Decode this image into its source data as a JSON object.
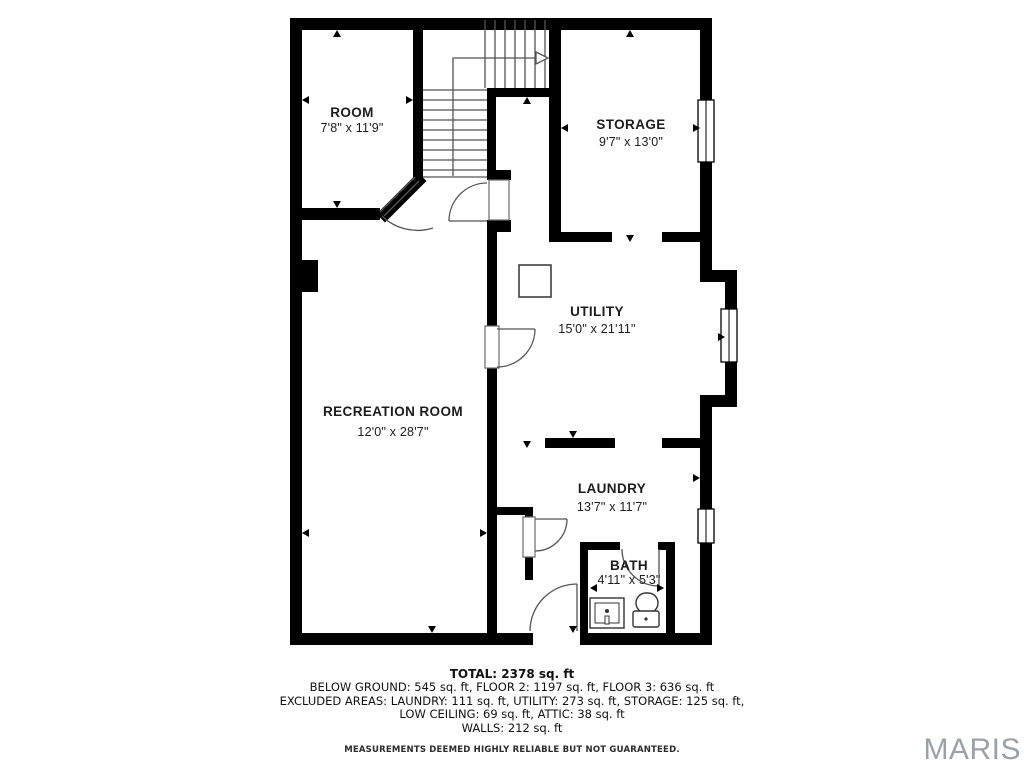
{
  "floorplan": {
    "rooms": [
      {
        "name": "ROOM",
        "dims": "7'8\" x 11'9\""
      },
      {
        "name": "STORAGE",
        "dims": "9'7\" x 13'0\""
      },
      {
        "name": "UTILITY",
        "dims": "15'0\" x 21'11\""
      },
      {
        "name": "RECREATION ROOM",
        "dims": "12'0\" x 28'7\""
      },
      {
        "name": "LAUNDRY",
        "dims": "13'7\" x 11'7\""
      },
      {
        "name": "BATH",
        "dims": "4'11\" x 5'3\""
      }
    ]
  },
  "summary": {
    "total": "TOTAL: 2378 sq. ft",
    "areas_line": "BELOW GROUND: 545 sq. ft, FLOOR 2: 1197 sq. ft, FLOOR 3: 636 sq. ft",
    "excluded_line1": "EXCLUDED AREAS: LAUNDRY: 111 sq. ft, UTILITY: 273 sq. ft, STORAGE: 125 sq. ft,",
    "excluded_line2": "LOW CEILING: 69 sq. ft, ATTIC: 38 sq. ft",
    "walls_line": "WALLS: 212 sq. ft",
    "disclaimer": "MEASUREMENTS DEEMED HIGHLY RELIABLE BUT NOT GUARANTEED."
  },
  "brand": {
    "name": "MARIS",
    "color": "#9aa2a8"
  },
  "colors": {
    "wall": "#000000",
    "thin_line": "#555555",
    "background": "#ffffff"
  }
}
